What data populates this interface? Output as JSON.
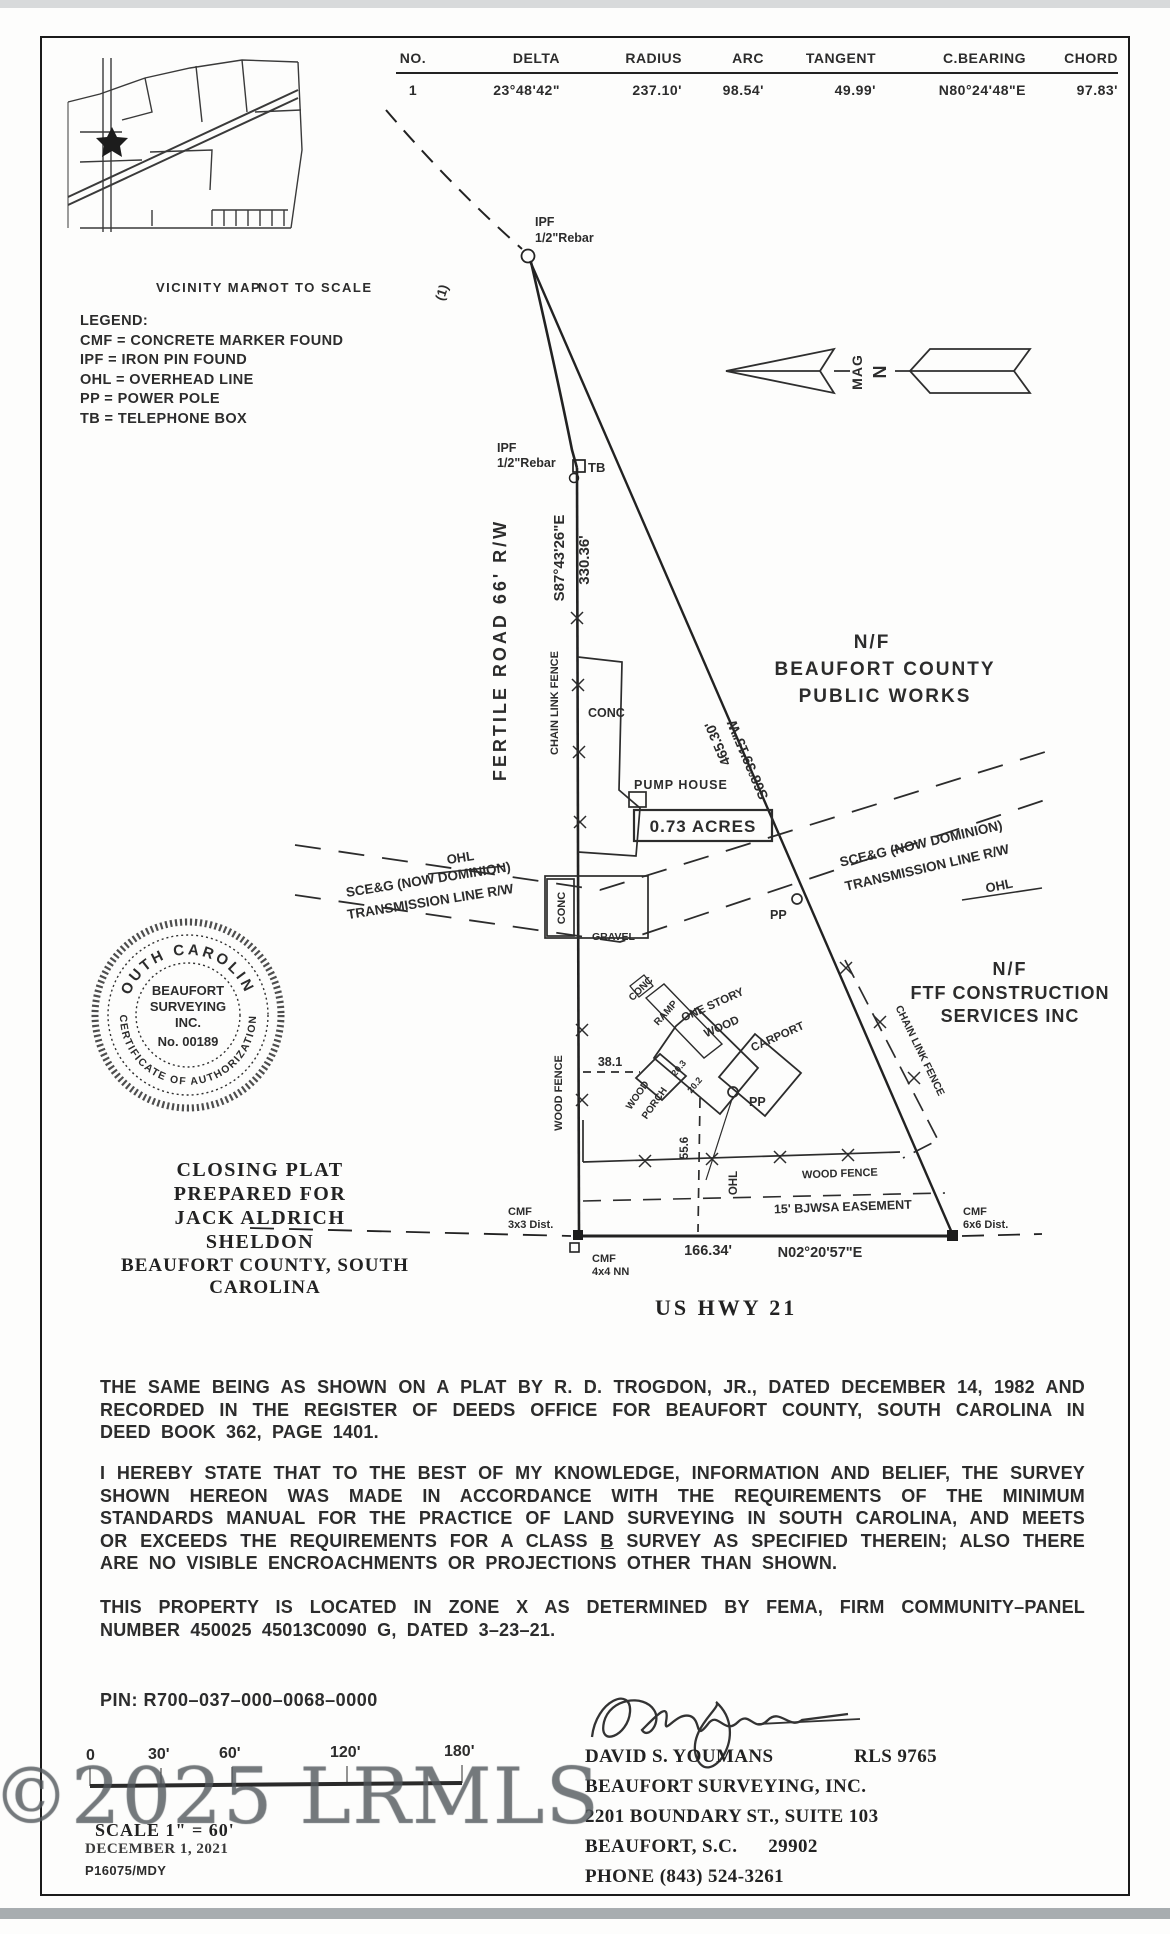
{
  "curve_table": {
    "headers": [
      "NO.",
      "DELTA",
      "RADIUS",
      "ARC",
      "TANGENT",
      "C.BEARING",
      "CHORD"
    ],
    "rows": [
      [
        "1",
        "23°48'42\"",
        "237.10'",
        "98.54'",
        "49.99'",
        "N80°24'48\"E",
        "97.83'"
      ]
    ]
  },
  "vicinity": {
    "caption_left": "VICINITY MAP",
    "caption_right": "NOT TO SCALE"
  },
  "legend": {
    "title": "LEGEND:",
    "items": [
      "CMF = CONCRETE MARKER FOUND",
      "IPF = IRON PIN FOUND",
      "OHL = OVERHEAD LINE",
      "PP = POWER POLE",
      "TB = TELEPHONE BOX"
    ]
  },
  "north_arrow": {
    "mag": "MAG",
    "n": "N"
  },
  "plat": {
    "ipf_top_1": "IPF",
    "ipf_top_2": "1/2\"Rebar",
    "curve_ref": "(1)",
    "ipf_mid_1": "IPF",
    "ipf_mid_2": "1/2\"Rebar",
    "tb": "TB",
    "road_name": "FERTILE ROAD 66' R/W",
    "bearing_road": "S87°43'26\"E",
    "dist_road": "330.36'",
    "chain_link_left": "CHAIN LINK FENCE",
    "chain_link_right": "CHAIN LINK FENCE",
    "conc_a": "CONC",
    "conc_b": "CONC",
    "conc_c": "CONC",
    "gravel": "GRAVEL",
    "pump_house": "PUMP HOUSE",
    "acreage": "0.73 ACRES",
    "ohl_left": "OHL",
    "ohl_right": "OHL",
    "ohl_bottom": "OHL",
    "sceg_left_1": "SCE&G (NOW DOMINION)",
    "sceg_left_2": "TRANSMISSION LINE R/W",
    "sceg_right_1": "SCE&G (NOW DOMINION)",
    "sceg_right_2": "TRANSMISSION LINE R/W",
    "nf_public_1": "N/F",
    "nf_public_2": "BEAUFORT COUNTY",
    "nf_public_3": "PUBLIC WORKS",
    "nf_ftf_1": "N/F",
    "nf_ftf_2": "FTF CONSTRUCTION",
    "nf_ftf_3": "SERVICES INC",
    "dist_diag": "465.30'",
    "bearing_diag": "S68°39'15\"W",
    "pp1": "PP",
    "pp2": "PP",
    "one_story_1": "ONE STORY",
    "one_story_2": "WOOD",
    "carport": "CARPORT",
    "ramp": "RAMP",
    "porch_1": "WOOD",
    "porch_2": "PORCH",
    "dim_38_1": "38.1",
    "dim_55_6": "55.6",
    "dim_20_3": "20.3",
    "dim_20_2": "20.2",
    "wood_fence_left": "WOOD FENCE",
    "wood_fence_bottom": "WOOD FENCE",
    "easement": "15' BJWSA EASEMENT",
    "cmf_3x3_1": "CMF",
    "cmf_3x3_2": "3x3 Dist.",
    "cmf_4x4_1": "CMF",
    "cmf_4x4_2": "4x4 NN",
    "cmf_6x6_1": "CMF",
    "cmf_6x6_2": "6x6 Dist.",
    "dist_bottom": "166.34'",
    "bearing_bottom": "N02°20'57\"E"
  },
  "seal": {
    "arc_top": "SOUTH CAROLINA",
    "arc_bottom": "CERTIFICATE OF AUTHORIZATION",
    "line1": "BEAUFORT",
    "line2": "SURVEYING",
    "line3": "INC.",
    "line4": "No. 00189"
  },
  "title_block": {
    "line1": "CLOSING PLAT",
    "line2": "PREPARED FOR",
    "line3": "JACK ALDRICH",
    "line4": "SHELDON",
    "county": "BEAUFORT COUNTY, SOUTH CAROLINA",
    "highway": "US HWY 21"
  },
  "notes": {
    "p1": "THE SAME BEING AS SHOWN ON A PLAT BY R. D. TROGDON, JR., DATED DECEMBER 14, 1982 AND RECORDED IN THE REGISTER OF DEEDS OFFICE FOR BEAUFORT COUNTY, SOUTH CAROLINA IN DEED BOOK 362, PAGE 1401.",
    "p2_before": "I HEREBY STATE THAT TO THE BEST OF MY KNOWLEDGE, INFORMATION AND BELIEF, THE SURVEY SHOWN HEREON WAS MADE IN ACCORDANCE WITH THE REQUIREMENTS OF THE MINIMUM STANDARDS MANUAL FOR THE PRACTICE OF LAND SURVEYING IN SOUTH CAROLINA, AND MEETS OR EXCEEDS THE REQUIREMENTS FOR A CLASS ",
    "p2_b": "B",
    "p2_after": " SURVEY AS SPECIFIED THEREIN; ALSO THERE ARE NO VISIBLE ENCROACHMENTS OR PROJECTIONS OTHER THAN SHOWN.",
    "p3": "THIS PROPERTY IS LOCATED IN ZONE X AS DETERMINED BY FEMA, FIRM COMMUNITY–PANEL NUMBER 450025 45013C0090 G, DATED 3–23–21.",
    "pin": "PIN: R700–037–000–0068–0000"
  },
  "scale_bar": {
    "ticks": [
      "0",
      "30'",
      "60'",
      "120'",
      "180'"
    ],
    "scale_text": "SCALE 1\" = 60'",
    "date_line": "DECEMBER 1, 2021",
    "job_no": "P16075/MDY"
  },
  "surveyor": {
    "name": "DAVID S. YOUMANS",
    "rls": "RLS 9765",
    "company": "BEAUFORT SURVEYING, INC.",
    "address1": "2201 BOUNDARY ST., SUITE 103",
    "address2": "BEAUFORT, S.C.      29902",
    "phone": "PHONE (843) 524-3261"
  },
  "watermark": "©2025 LRMLS"
}
